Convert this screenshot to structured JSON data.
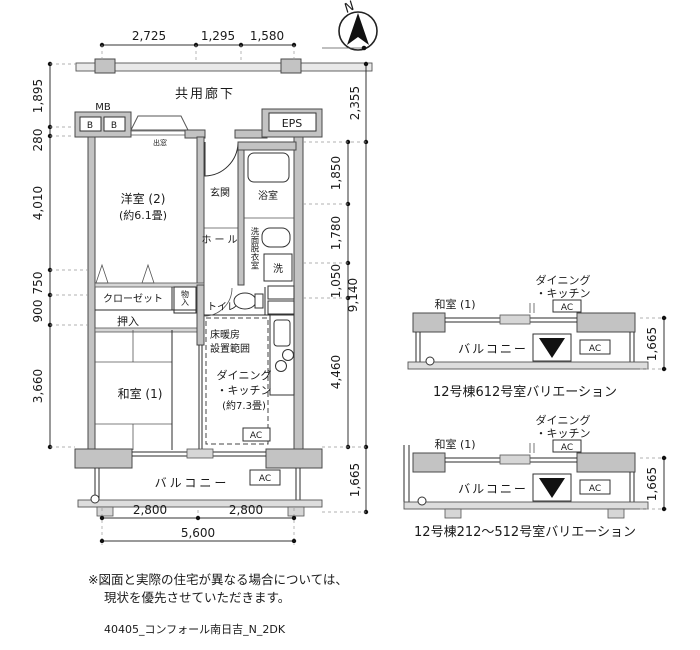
{
  "colors": {
    "ink": "#1a1a1a",
    "wall_fill": "#c3c3c3",
    "wall_edge": "#4a4a4a",
    "background": "#ffffff"
  },
  "compass": {
    "north_label": "N"
  },
  "corridor_label": "共用廊下",
  "main_plan": {
    "labels": {
      "mb": "MB",
      "b_left": "B",
      "b_right": "B",
      "eps": "EPS",
      "bay_window": "出窓",
      "western_room_name": "洋室 (2)",
      "western_room_size": "(約6.1畳)",
      "entrance": "玄関",
      "hall": "ホール",
      "bath": "浴室",
      "washroom": "洗面脱衣室",
      "washer": "洗",
      "closet": "クローゼット",
      "storage": "物入",
      "oshiire": "押入",
      "toilet": "トイレ",
      "japanese_room": "和室 (1)",
      "floor_heating_line1": "床暖房",
      "floor_heating_line2": "設置範囲",
      "dk_line1": "ダイニング",
      "dk_line2": "・キッチン",
      "dk_line3": "(約7.3畳)",
      "ac_dk": "AC",
      "ac_balcony": "AC",
      "balcony": "バルコニー"
    },
    "dimensions": {
      "top": [
        "2,725",
        "1,295",
        "1,580"
      ],
      "left": [
        "1,895",
        "280",
        "4,010",
        "750",
        "900",
        "3,660"
      ],
      "right_inner": [
        "1,850",
        "1,780",
        "1,050",
        "4,460"
      ],
      "right_outer": [
        "2,355",
        "9,140",
        "1,665"
      ],
      "bottom_upper": [
        "2,800",
        "2,800"
      ],
      "bottom_total": "5,600"
    }
  },
  "variation_upper": {
    "dk_line1": "ダイニング",
    "dk_line2": "・キッチン",
    "japanese_room": "和室 (1)",
    "ac_top": "AC",
    "ac_side": "AC",
    "balcony": "バルコニー",
    "dim_right": "1,665",
    "caption": "12号棟612号室バリエーション"
  },
  "variation_lower": {
    "dk_line1": "ダイニング",
    "dk_line2": "・キッチン",
    "japanese_room": "和室 (1)",
    "ac_top": "AC",
    "ac_side": "AC",
    "balcony": "バルコニー",
    "dim_right": "1,665",
    "caption": "12号棟212〜512号室バリエーション"
  },
  "notes": {
    "line1": "※図面と実際の住宅が異なる場合については、",
    "line2": "現状を優先させていただきます。"
  },
  "file_label": "40405_コンフォール南日吉_N_2DK"
}
